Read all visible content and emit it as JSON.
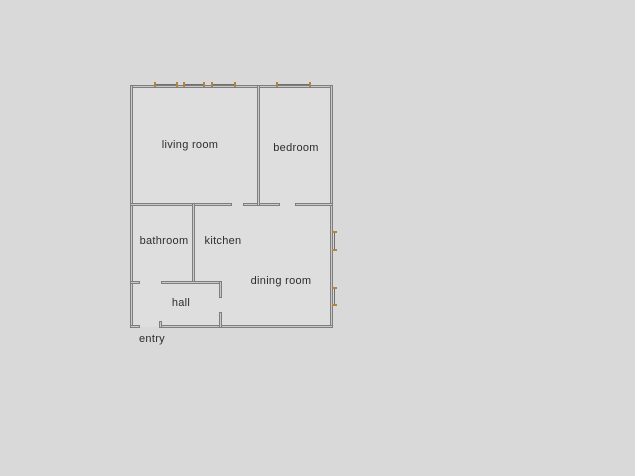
{
  "floor_plan": {
    "title": "apartment-floor-plan",
    "rooms": [
      {
        "id": "living-room",
        "label": "living room"
      },
      {
        "id": "bedroom",
        "label": "bedroom"
      },
      {
        "id": "bathroom",
        "label": "bathroom"
      },
      {
        "id": "kitchen",
        "label": "kitchen"
      },
      {
        "id": "dining-room",
        "label": "dining room"
      },
      {
        "id": "hall",
        "label": "hall"
      },
      {
        "id": "entry",
        "label": "entry"
      }
    ],
    "window_count": 6,
    "door_opening_count": 5,
    "colors": {
      "background": "#d9d9d9",
      "room_fill": "#dedede",
      "wall_fill": "#c9c9c9",
      "wall_edge": "#7e7e7e",
      "window_accent": "#b5833f",
      "label_text": "#2d2d2d"
    }
  }
}
